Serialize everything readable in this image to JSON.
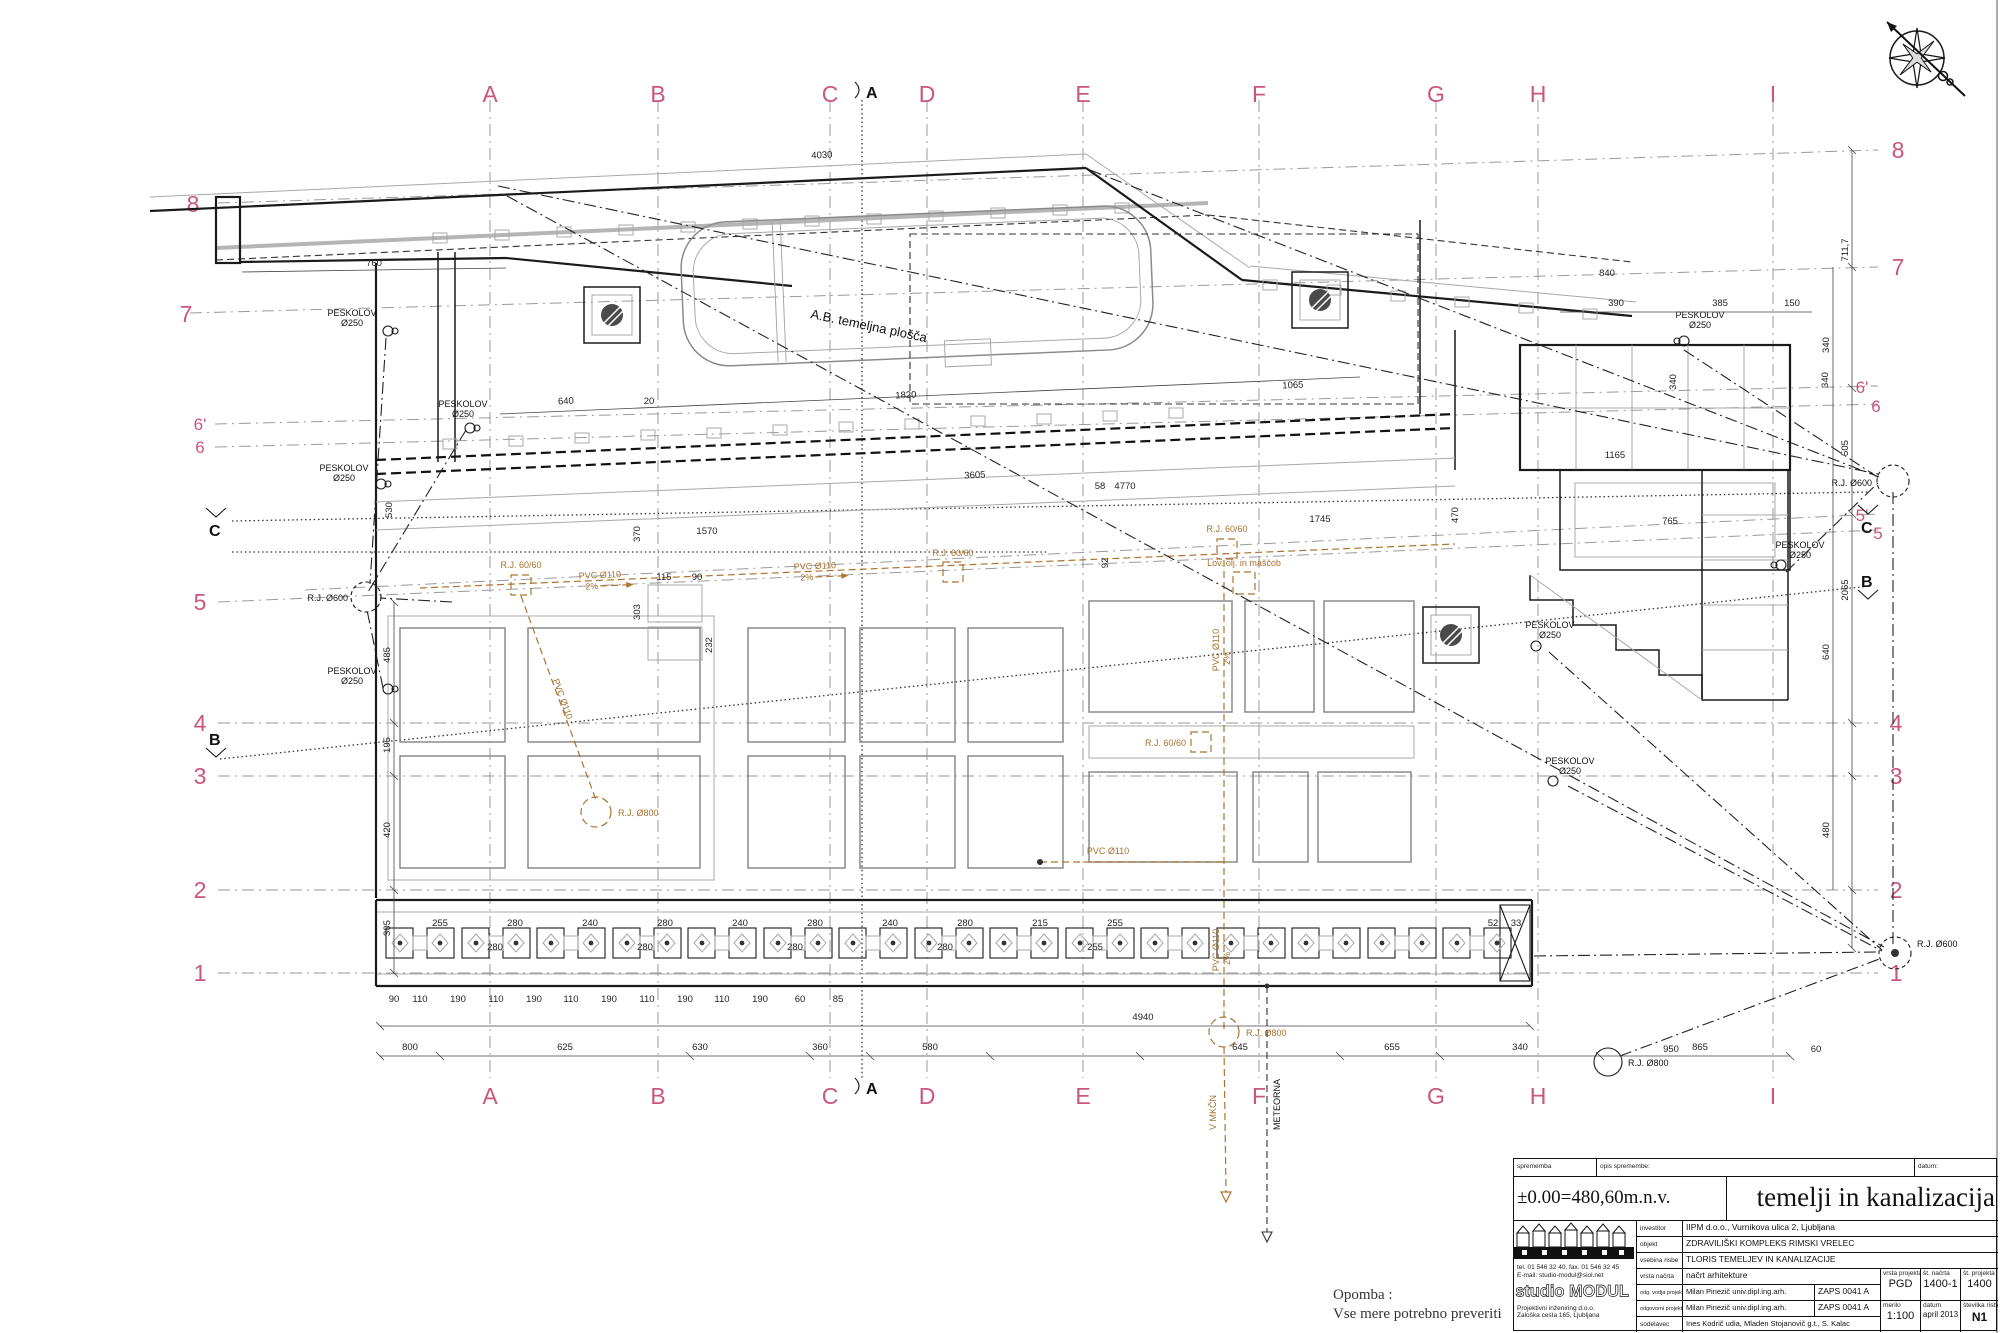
{
  "colors": {
    "grid_pink": "#c9577a",
    "sewer_brown": "#ad7430",
    "ink": "#1a1a1a",
    "gray": "#999999"
  },
  "grid": {
    "cols": [
      "A",
      "B",
      "C",
      "D",
      "E",
      "F",
      "G",
      "H",
      "I"
    ],
    "rows_left": [
      "8",
      "7",
      "6'",
      "6",
      "5",
      "4",
      "3",
      "2",
      "1"
    ],
    "rows_right": [
      "8",
      "7",
      "6'",
      "6",
      "5'",
      "5",
      "4",
      "3",
      "2",
      "1"
    ]
  },
  "sections": {
    "a": "A",
    "b": "B",
    "c": "C"
  },
  "ann": {
    "slab": "A.B. temeljna plošča",
    "peskolov": "PESKOLOV",
    "fi250": "Ø250",
    "rj600": "R.J. Ø600",
    "rj800": "R.J. Ø800",
    "rj6060": "R.J. 60/60",
    "pvc110": "PVC Ø110",
    "slope": "2%",
    "grease": "Lov. olj. in maščob",
    "mkcn": "V MKČN",
    "meteorna": "METEORNA"
  },
  "dims_top": [
    "4030",
    "760",
    "640",
    "20",
    "1820",
    "1065",
    "3605",
    "1570",
    "370",
    "530",
    "4770",
    "58",
    "1745",
    "470",
    "92",
    "390",
    "385",
    "150",
    "340",
    "340",
    "1165",
    "765",
    "840"
  ],
  "dims_left": [
    "485",
    "195",
    "420",
    "305"
  ],
  "dims_right": [
    "711,7",
    "340",
    "505",
    "2065",
    "640",
    "480"
  ],
  "dims_pads_a": [
    "255",
    "280",
    "240",
    "280",
    "240",
    "280",
    "240",
    "280",
    "215",
    "255",
    "52",
    "33"
  ],
  "dims_pads_b": [
    "280",
    "280",
    "280",
    "280",
    "255"
  ],
  "dims_pads_c": [
    "90",
    "110",
    "190",
    "110",
    "190",
    "110",
    "190",
    "110",
    "190",
    "110",
    "190",
    "60",
    "85"
  ],
  "dims_pads_d": [
    "950",
    "60"
  ],
  "dims_bottom": [
    "4940",
    "800",
    "625",
    "630",
    "360",
    "580",
    "645",
    "655",
    "340",
    "865"
  ],
  "dims_cells": [
    "303",
    "115",
    "90",
    "232"
  ],
  "note": {
    "line1": "Opomba :",
    "line2": "Vse mere potrebno preveriti"
  },
  "titleblock": {
    "rev_label": "sprememba",
    "rev_desc_label": "opis spremembe:",
    "rev_date_label": "datum:",
    "elevation": "±0.00=480,60m.n.v.",
    "sheet_title": "temelji in kanalizacija",
    "firm": {
      "name": "studio MODUL",
      "tel": "tel. 01 546 32 40, fax. 01 546 32 45",
      "email": "E-mail: studio-modul@siol.net",
      "desc": "Projektivni inženiring d.o.o.",
      "address": "Zaloška cesta 165, Ljubljana"
    },
    "rows": {
      "investor_label": "investitor",
      "investor": "IIPM d.o.o., Vurnikova ulica 2, Ljubljana",
      "object_label": "objekt",
      "object": "ZDRAVILIŠKI KOMPLEKS RIMSKI VRELEC",
      "content_label": "vsebina risbe",
      "content": "TLORIS TEMELJEV IN KANALIZACIJE",
      "plan_type_label": "vrsta načrta",
      "plan_type": "načrt arhitekture",
      "lead_label": "odg. vodja projekta",
      "lead": "Milan Pinezič univ.dipl.ing.arh.",
      "lead_id": "ZAPS 0041 A",
      "designer_label": "odgovorni projektant",
      "designer": "Milan Pinezič univ.dipl.ing.arh.",
      "designer_id": "ZAPS 0041 A",
      "collab_label": "sodelavec",
      "collab": "Ines Kodrič udia, Mladen Stojanovič g.t., S. Kalac",
      "proj_type_label": "vrsta projekta",
      "proj_type": "PGD",
      "plan_no_label": "št. načrta",
      "plan_no": "1400-1",
      "proj_no_label": "št. projekta",
      "proj_no": "1400",
      "scale_label": "merilo",
      "scale": "1:100",
      "date_label": "datum",
      "date": "april 2013",
      "sheet_no_label": "številka risbe",
      "sheet_no": "N1"
    }
  }
}
